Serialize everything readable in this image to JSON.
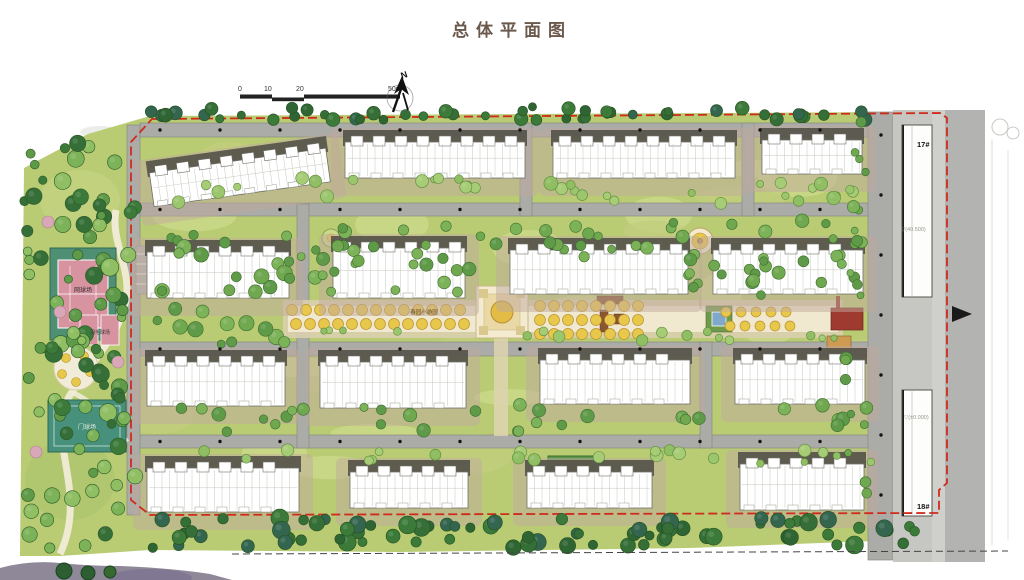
{
  "title": "总体平面图",
  "north": {
    "label": "N"
  },
  "scale_bar": {
    "ticks": [
      "0",
      "10",
      "20",
      "50m"
    ]
  },
  "site_labels": {
    "central_garden": "春园小游园",
    "tennis_court": "网球场",
    "badminton_court": "羽毛球场",
    "gateball_court": "门球场"
  },
  "buildings": {
    "b17": "17#",
    "b18": "18#"
  },
  "elevations": {
    "north_gate": "▽(40.500)",
    "south_gate": "▽(±0.000)"
  },
  "colors": {
    "boundary_red": "#cf2b1c",
    "road_gray": "#ababa7",
    "lawn_green": "#b9cc74",
    "tree_dark_green": "#3c7a3a",
    "court_teal": "#4f8f74",
    "court_pink": "#d793a0",
    "axis_yellow": "#e8c84a"
  }
}
